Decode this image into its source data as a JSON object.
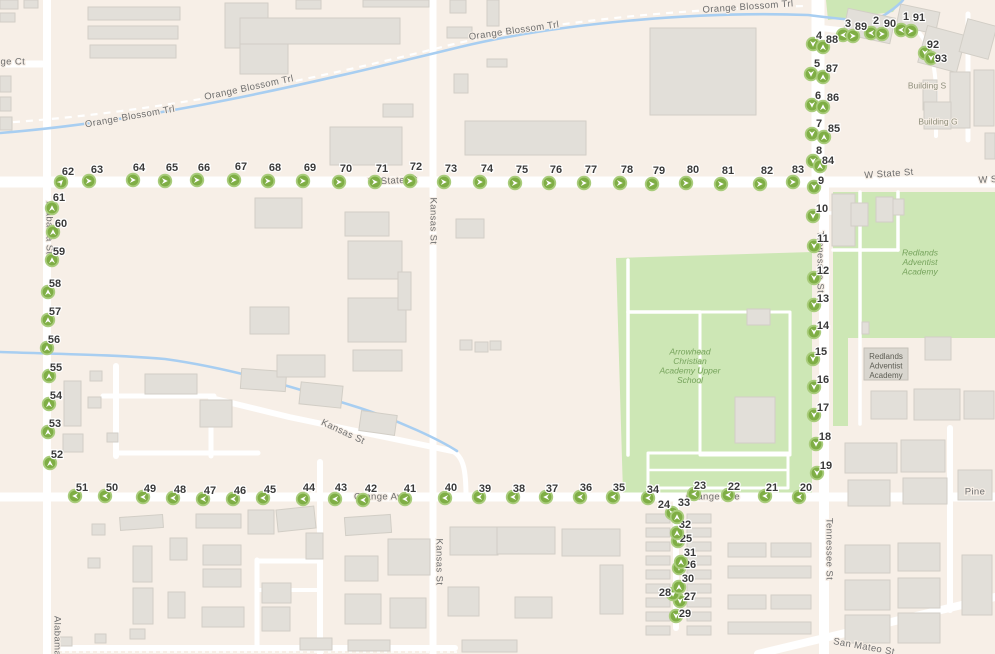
{
  "map": {
    "colors": {
      "background": "#f7efe7",
      "road": "#ffffff",
      "road_casing": "#e4dfd7",
      "building": "#e2dfd9",
      "building_border": "#d2cec6",
      "park_green": "#cde7b5",
      "water_blue": "#a8cef1",
      "marker_fill": "#7fae45",
      "marker_ring": "#a9cc7c",
      "marker_arrow": "#ffffff",
      "label_gray": "#6e6e6e",
      "green_label": "#76a35c"
    },
    "street_labels": [
      {
        "text": "nge Ct",
        "x": 10,
        "y": 62,
        "rot": 0,
        "style": "street"
      },
      {
        "text": "Orange Blossom Trl",
        "x": 130,
        "y": 117,
        "rot": -10,
        "style": "street"
      },
      {
        "text": "Orange Blossom Trl",
        "x": 249,
        "y": 88,
        "rot": -12,
        "style": "street"
      },
      {
        "text": "Orange Blossom Trl",
        "x": 514,
        "y": 31,
        "rot": -8,
        "style": "street"
      },
      {
        "text": "Orange Blossom Trl",
        "x": 748,
        "y": 7,
        "rot": -4,
        "style": "street"
      },
      {
        "text": "W State St",
        "x": 393,
        "y": 181,
        "rot": -3,
        "style": "street"
      },
      {
        "text": "W State St",
        "x": 889,
        "y": 174,
        "rot": -4,
        "style": "street"
      },
      {
        "text": "W S",
        "x": 988,
        "y": 180,
        "rot": -3,
        "style": "street"
      },
      {
        "text": "Kansas St",
        "x": 433,
        "y": 221,
        "rot": 90,
        "style": "street"
      },
      {
        "text": "Kansas St",
        "x": 343,
        "y": 432,
        "rot": 25,
        "style": "street"
      },
      {
        "text": "Kansas St",
        "x": 439,
        "y": 562,
        "rot": 90,
        "style": "street"
      },
      {
        "text": "Alabama St",
        "x": 49,
        "y": 228,
        "rot": 90,
        "style": "street"
      },
      {
        "text": "Alabama",
        "x": 57,
        "y": 636,
        "rot": 90,
        "style": "street"
      },
      {
        "text": "Tennessee St",
        "x": 820,
        "y": 262,
        "rot": 90,
        "style": "street"
      },
      {
        "text": "Tennessee St",
        "x": 829,
        "y": 549,
        "rot": 90,
        "style": "street"
      },
      {
        "text": "Orange Ave",
        "x": 381,
        "y": 497,
        "rot": 0,
        "style": "street"
      },
      {
        "text": "Orange Ave",
        "x": 713,
        "y": 497,
        "rot": 0,
        "style": "street"
      },
      {
        "text": "Pine",
        "x": 975,
        "y": 492,
        "rot": 0,
        "style": "street"
      },
      {
        "text": "San Mateo St",
        "x": 864,
        "y": 647,
        "rot": 10,
        "style": "street"
      },
      {
        "text": "Building S",
        "x": 927,
        "y": 86,
        "rot": 0,
        "style": "building"
      },
      {
        "text": "Building G",
        "x": 938,
        "y": 122,
        "rot": 0,
        "style": "building"
      }
    ],
    "poi_labels": [
      {
        "lines": [
          "Arrowhead",
          "Christian",
          "Academy Upper",
          "School"
        ],
        "x": 690,
        "y": 352,
        "style": "green"
      },
      {
        "lines": [
          "Redlands",
          "Adventist",
          "Academy"
        ],
        "x": 920,
        "y": 253,
        "style": "green"
      },
      {
        "lines": [
          "Redlands",
          "Adventist",
          "Academy"
        ],
        "x": 886,
        "y": 357,
        "style": "box"
      }
    ],
    "route_markers": [
      [
        1,
        901,
        30,
        "L",
        906,
        17
      ],
      [
        2,
        871,
        33,
        "L",
        876,
        21
      ],
      [
        3,
        843,
        35,
        "L",
        848,
        24
      ],
      [
        4,
        813,
        44,
        "D",
        819,
        36
      ],
      [
        5,
        811,
        74,
        "D",
        817,
        64
      ],
      [
        6,
        812,
        105,
        "D",
        818,
        96
      ],
      [
        7,
        812,
        134,
        "D",
        819,
        124
      ],
      [
        8,
        813,
        161,
        "D",
        819,
        151
      ],
      [
        9,
        814,
        187,
        "D",
        821,
        181
      ],
      [
        10,
        813,
        216,
        "D",
        822,
        209
      ],
      [
        11,
        814,
        246,
        "D",
        823,
        239
      ],
      [
        12,
        814,
        278,
        "D",
        823,
        271
      ],
      [
        13,
        814,
        305,
        "D",
        823,
        299
      ],
      [
        14,
        814,
        332,
        "D",
        823,
        326
      ],
      [
        15,
        813,
        359,
        "D",
        821,
        352
      ],
      [
        16,
        814,
        387,
        "D",
        823,
        380
      ],
      [
        17,
        814,
        415,
        "D",
        823,
        408
      ],
      [
        18,
        816,
        444,
        "D",
        825,
        437
      ],
      [
        19,
        817,
        473,
        "D",
        826,
        466
      ],
      [
        20,
        799,
        497,
        "L",
        806,
        488
      ],
      [
        21,
        765,
        496,
        "L",
        772,
        488
      ],
      [
        22,
        728,
        495,
        "L",
        734,
        487
      ],
      [
        23,
        694,
        494,
        "L",
        700,
        486
      ],
      [
        24,
        672,
        513,
        "D",
        664,
        505
      ],
      [
        25,
        678,
        541,
        "D",
        686,
        539
      ],
      [
        26,
        679,
        568,
        "D",
        690,
        565
      ],
      [
        27,
        680,
        601,
        "D",
        690,
        597
      ],
      [
        28,
        673,
        594,
        "D",
        665,
        593
      ],
      [
        29,
        676,
        616,
        "D",
        685,
        614
      ],
      [
        30,
        679,
        587,
        "U",
        688,
        579
      ],
      [
        31,
        681,
        562,
        "U",
        690,
        553
      ],
      [
        32,
        677,
        533,
        "U",
        685,
        525
      ],
      [
        33,
        677,
        517,
        "U",
        684,
        503
      ],
      [
        34,
        648,
        498,
        "L",
        653,
        490
      ],
      [
        35,
        613,
        497,
        "L",
        619,
        488
      ],
      [
        36,
        580,
        497,
        "L",
        586,
        488
      ],
      [
        37,
        546,
        497,
        "L",
        552,
        489
      ],
      [
        38,
        513,
        497,
        "L",
        519,
        489
      ],
      [
        39,
        479,
        497,
        "L",
        485,
        489
      ],
      [
        40,
        445,
        498,
        "L",
        451,
        488
      ],
      [
        41,
        405,
        499,
        "L",
        410,
        489
      ],
      [
        42,
        363,
        500,
        "L",
        371,
        489
      ],
      [
        43,
        335,
        499,
        "L",
        341,
        488
      ],
      [
        44,
        303,
        499,
        "L",
        309,
        488
      ],
      [
        45,
        263,
        498,
        "L",
        270,
        490
      ],
      [
        46,
        233,
        499,
        "L",
        240,
        491
      ],
      [
        47,
        203,
        499,
        "L",
        210,
        491
      ],
      [
        48,
        173,
        498,
        "L",
        180,
        490
      ],
      [
        49,
        143,
        497,
        "L",
        150,
        489
      ],
      [
        50,
        105,
        496,
        "L",
        112,
        488
      ],
      [
        51,
        75,
        496,
        "L",
        82,
        488
      ],
      [
        52,
        50,
        463,
        "U",
        57,
        455
      ],
      [
        53,
        48,
        432,
        "U",
        55,
        424
      ],
      [
        54,
        49,
        404,
        "U",
        56,
        396
      ],
      [
        55,
        49,
        376,
        "U",
        56,
        368
      ],
      [
        56,
        47,
        348,
        "U",
        54,
        340
      ],
      [
        57,
        48,
        320,
        "U",
        55,
        312
      ],
      [
        58,
        48,
        292,
        "U",
        55,
        284
      ],
      [
        59,
        52,
        260,
        "U",
        59,
        252
      ],
      [
        60,
        53,
        232,
        "U",
        61,
        224
      ],
      [
        61,
        52,
        208,
        "U",
        59,
        198
      ],
      [
        62,
        61,
        182,
        "UR",
        68,
        172
      ],
      [
        63,
        89,
        181,
        "R",
        97,
        170
      ],
      [
        64,
        133,
        180,
        "R",
        139,
        168
      ],
      [
        65,
        165,
        181,
        "R",
        172,
        168
      ],
      [
        66,
        197,
        180,
        "R",
        204,
        168
      ],
      [
        67,
        234,
        180,
        "R",
        241,
        167
      ],
      [
        68,
        268,
        181,
        "R",
        275,
        168
      ],
      [
        69,
        303,
        181,
        "R",
        310,
        168
      ],
      [
        70,
        339,
        182,
        "R",
        346,
        169
      ],
      [
        71,
        375,
        182,
        "R",
        382,
        169
      ],
      [
        72,
        410,
        181,
        "R",
        416,
        167
      ],
      [
        73,
        444,
        182,
        "R",
        451,
        169
      ],
      [
        74,
        480,
        182,
        "R",
        487,
        169
      ],
      [
        75,
        515,
        183,
        "R",
        522,
        170
      ],
      [
        76,
        549,
        183,
        "R",
        556,
        170
      ],
      [
        77,
        584,
        183,
        "R",
        591,
        170
      ],
      [
        78,
        620,
        183,
        "R",
        627,
        170
      ],
      [
        79,
        652,
        184,
        "R",
        659,
        171
      ],
      [
        80,
        686,
        183,
        "R",
        693,
        170
      ],
      [
        81,
        721,
        184,
        "R",
        728,
        171
      ],
      [
        82,
        760,
        184,
        "R",
        767,
        171
      ],
      [
        83,
        793,
        182,
        "R",
        798,
        170
      ],
      [
        84,
        820,
        166,
        "U",
        828,
        161
      ],
      [
        85,
        824,
        137,
        "U",
        834,
        129
      ],
      [
        86,
        823,
        107,
        "U",
        833,
        98
      ],
      [
        87,
        823,
        77,
        "U",
        832,
        69
      ],
      [
        88,
        823,
        47,
        "U",
        832,
        40
      ],
      [
        89,
        853,
        36,
        "R",
        861,
        27
      ],
      [
        90,
        882,
        34,
        "R",
        890,
        24
      ],
      [
        91,
        911,
        31,
        "R",
        919,
        18
      ],
      [
        92,
        925,
        53,
        "D",
        933,
        45
      ],
      [
        93,
        931,
        58,
        "D",
        941,
        59
      ]
    ]
  }
}
